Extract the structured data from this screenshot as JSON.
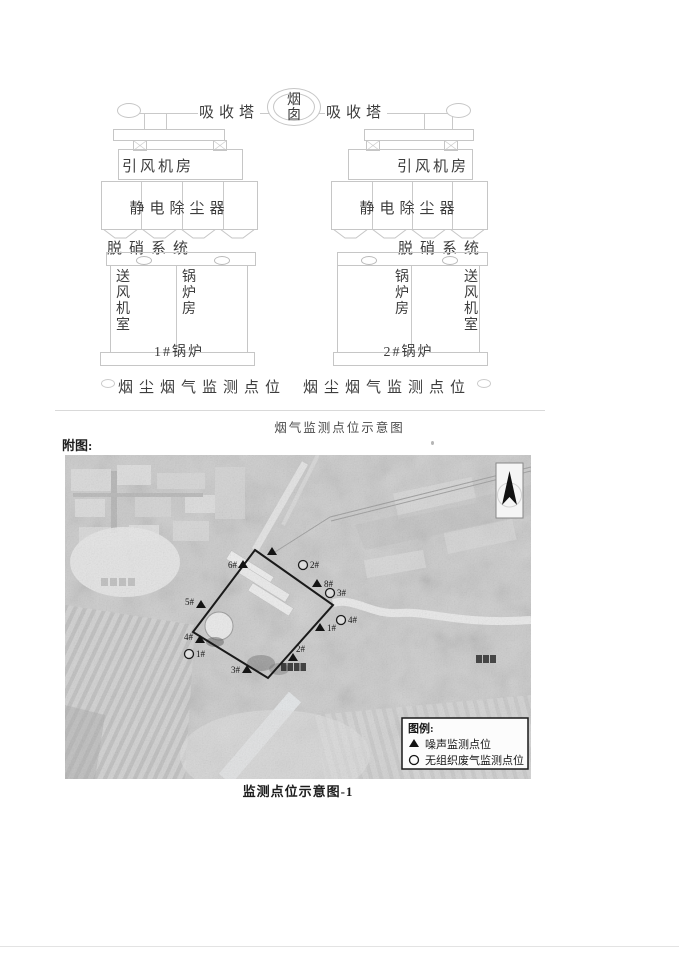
{
  "document": {
    "diagram_caption": "烟气监测点位示意图",
    "attachment_label": "附图:",
    "map_caption": "监测点位示意图-1"
  },
  "diagram": {
    "chimney": "烟囱",
    "absorber": "吸收塔",
    "id_fan_room": "引风机房",
    "esp": "静电除尘器",
    "denox_system": "脱硝系统",
    "supply_fan_room": "送风机室",
    "boiler_house": "锅炉房",
    "boiler_1": "1#锅炉",
    "boiler_2": "2#锅炉",
    "dust_gas_monitoring_point": "烟尘烟气监测点位"
  },
  "map": {
    "legend_title": "图例:",
    "legend_noise": "噪声监测点位",
    "legend_gas": "无组织废气监测点位",
    "noise_points": {
      "p1": "1#",
      "p2": "2#",
      "p3": "3#",
      "p4": "4#",
      "p5": "5#",
      "p6": "6#",
      "p8": "8#"
    },
    "gas_points": {
      "p1": "1#",
      "p2": "2#",
      "p3": "3#",
      "p4": "4#"
    }
  },
  "colors": {
    "boundary": "#1a1a1a",
    "diagram_line": "#c6c6c6",
    "caption_text": "#4a4a4a"
  }
}
